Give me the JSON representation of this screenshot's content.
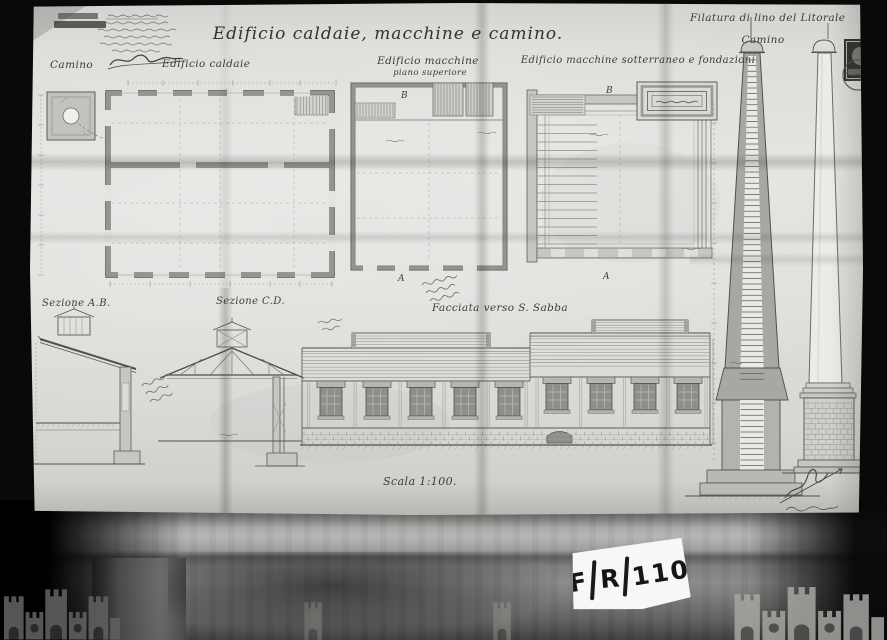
{
  "archive": {
    "code": "F/R/110",
    "code_parts": [
      "F",
      "R",
      "110"
    ]
  },
  "sheet": {
    "title": "Edificio caldaie, macchine e camino.",
    "project_heading": "Filatura di lino del Litorale",
    "scale_note": "Scala 1:100.",
    "labels": {
      "camino_plan": "Camino",
      "edificio_caldaie": "Edificio caldaie",
      "edificio_macchine": "Edificio macchine",
      "piano_superiore": "piano superiore",
      "edificio_macchine_sotterraneo": "Edificio macchine sotterraneo e fondazioni",
      "sezione_ab": "Sezione A.B.",
      "sezione_cd": "Sezione C.D.",
      "facciata": "Facciata verso S. Sabba",
      "camino_elevazione": "Camino",
      "marker_a": "A",
      "marker_b": "B"
    }
  }
}
